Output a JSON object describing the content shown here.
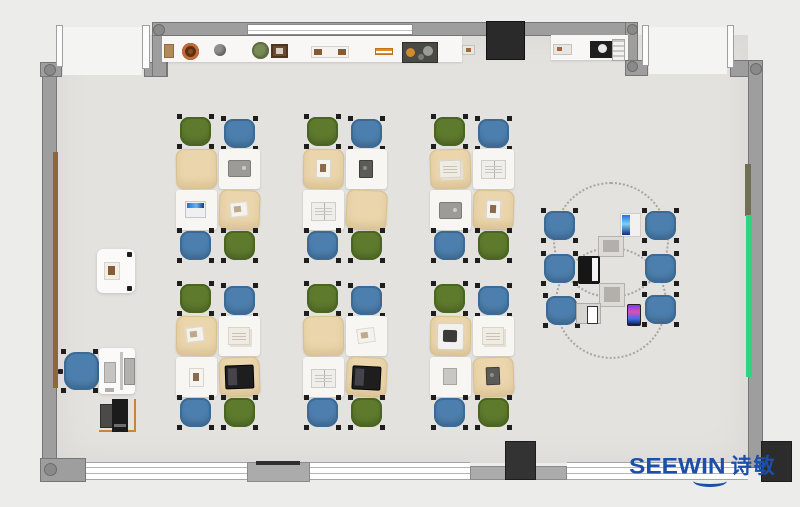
{
  "branding": {
    "logo_text": "SEEWIN",
    "logo_cn": "诗敏",
    "logo_color": "#1c4fa9"
  },
  "scene": {
    "type": "3D-rendered top-down floor plan of a classroom / training office",
    "student_area": {
      "cluster_count": 6,
      "cluster_grid": "3 columns x 2 rows",
      "desks_per_cluster": 4,
      "chairs_per_cluster": 4,
      "chair_colors": {
        "green": "#5d7a2d",
        "blue": "#4c7fae"
      },
      "desk_colors": {
        "tan_cover": "#ebd5ac",
        "white_top": "#f7f6f3"
      }
    },
    "collaboration_area": {
      "blue_chairs": 6,
      "dashed_table_outlines": 2,
      "devices_on_tables": [
        "laptop with blue screen",
        "gray tablet",
        "black laptop",
        "gray tablet",
        "white laptop",
        "smartphone"
      ]
    },
    "teacher_area": {
      "elements": [
        "side cabinet",
        "teacher desk with monitor and keyboard",
        "blue swivel chair",
        "printer on side table"
      ]
    },
    "room": {
      "wall_color": "#9e9e9e",
      "floor_color": "#e3e2df",
      "tv_panel_color": "#2a2a2a",
      "green_board_right_wall": "#2ed57f",
      "wood_rail_left_wall": "#8b6a34",
      "entrances": 2,
      "shelf_top_wall_items": [
        "box",
        "clay pot",
        "sphere",
        "plant",
        "picture frame",
        "tray",
        "orange rails",
        "tool box",
        "small tray",
        "speaker",
        "rack"
      ]
    }
  }
}
